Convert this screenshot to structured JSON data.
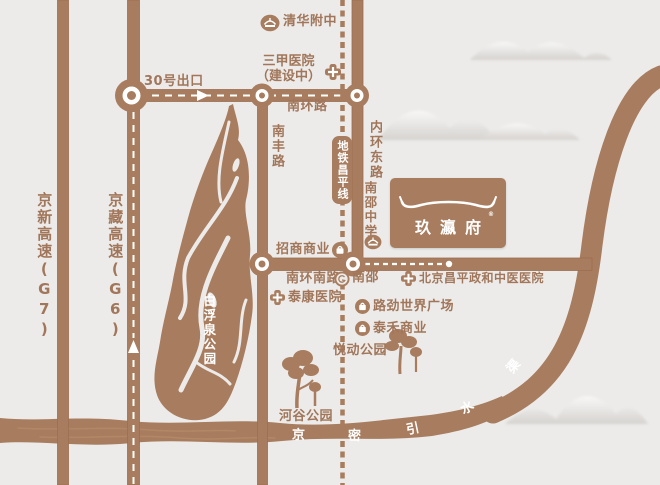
{
  "colors": {
    "brown": "#a87c5e",
    "background": "#ecebe9",
    "label_text": "#a1765a"
  },
  "highways": {
    "g7": "京新高速(G7)",
    "g6": "京藏高速(G6)"
  },
  "exit_label": "30号出口",
  "roads": {
    "south_ring": "南环路",
    "nanfeng": "南丰路",
    "inner_east": "内环东路",
    "south_ring_south": "南环南路"
  },
  "metro": {
    "badge": "地铁昌平线",
    "station": "南邵"
  },
  "schools": {
    "qinghua": "清华附中",
    "nanshao": "南邵中学"
  },
  "hospitals": {
    "sanjia_line1": "三甲医院",
    "sanjia_line2": "（建设中）",
    "taikang": "泰康医院",
    "zhenghe": "北京昌平政和中医医院"
  },
  "commerce": {
    "zhaoshang": "招商商业",
    "lujin": "路劲世界广场",
    "taihe": "泰禾商业"
  },
  "parks": {
    "baifuquan": "白浮泉公园",
    "yuedong": "悦动公园",
    "hegu": "河谷公园"
  },
  "project": {
    "name": "玖瀛府",
    "mark": "®"
  },
  "canal_chars": [
    "京",
    "密",
    "引",
    "水",
    "渠"
  ]
}
